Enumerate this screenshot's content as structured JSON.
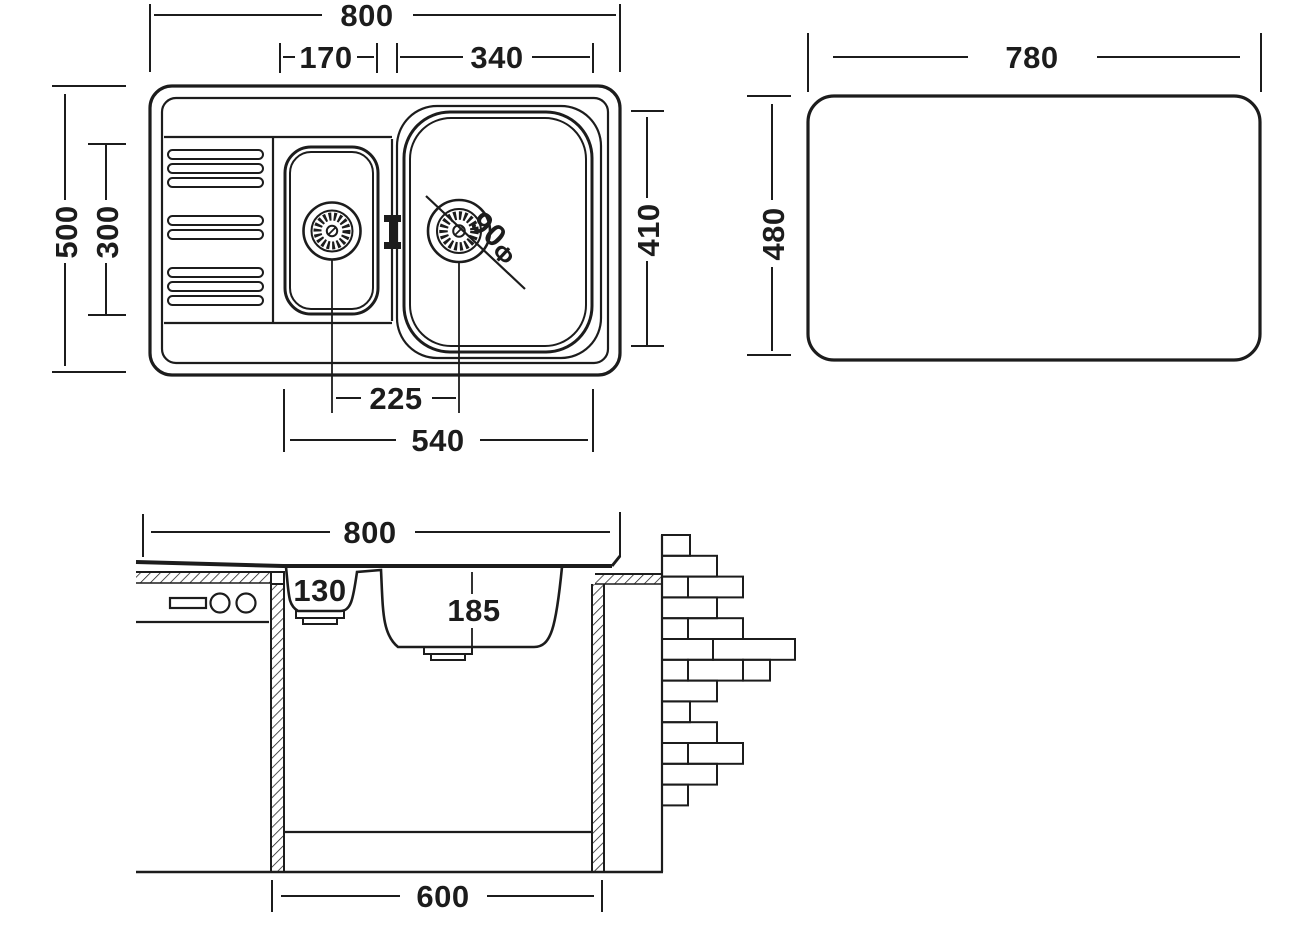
{
  "style": {
    "ink": "#1c1c1c",
    "background": "#ffffff"
  },
  "top_view": {
    "title": "sink-top-view",
    "dims": {
      "overall_width": "800",
      "small_bowl_width": "170",
      "large_bowl_width": "340",
      "overall_depth": "500",
      "small_bowl_length": "300",
      "large_bowl_length": "410",
      "drain_spacing": "225",
      "bowls_span": "540",
      "drain_diameter": "90",
      "drain_diameter_symbol": "Φ"
    }
  },
  "cutout_view": {
    "title": "countertop-cutout",
    "dims": {
      "width": "780",
      "height": "480"
    }
  },
  "section_view": {
    "title": "sink-section-view",
    "dims": {
      "overall_width": "800",
      "small_bowl_depth": "130",
      "large_bowl_depth": "185",
      "cabinet_width": "600"
    }
  },
  "drawing": {
    "brick_wall": {
      "x": 662,
      "top": 535,
      "bottom": 872,
      "row_height": 20.8,
      "rows": [
        [
          28
        ],
        [
          55
        ],
        [
          26,
          55
        ],
        [
          55
        ],
        [
          26,
          55
        ],
        [
          51,
          82
        ],
        [
          26,
          55,
          27
        ],
        [
          55
        ],
        [
          28
        ],
        [
          55
        ],
        [
          26,
          55
        ],
        [
          55
        ],
        [
          26
        ]
      ]
    }
  }
}
